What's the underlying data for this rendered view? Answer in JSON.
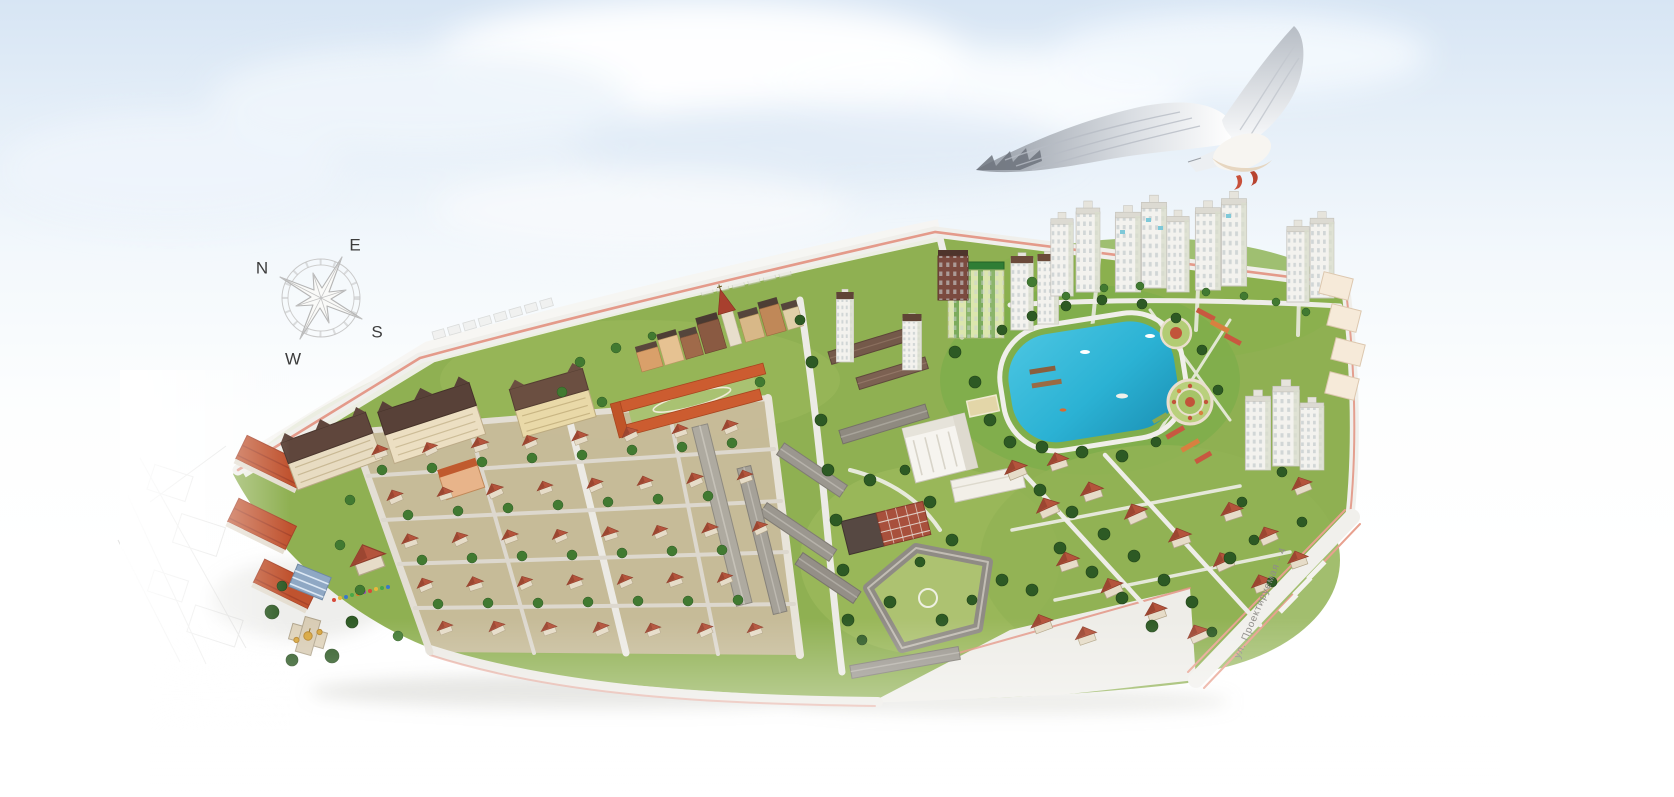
{
  "compass": {
    "north": "N",
    "east": "E",
    "south": "S",
    "west": "W"
  },
  "labels": {
    "street_right_edge": "ул. Проектируемая - 4"
  },
  "icons": {
    "compass-rose-icon": "light-gray line-art eight-point wind rose, tilted, letters at long points",
    "seagull-image": "white seagull photo overlay flying over the plan, wings spread, red feet"
  },
  "colors": {
    "sky_top": "#d7e5f4",
    "sky_bottom": "#ffffff",
    "grass": "#8fb052",
    "grass_dark": "#6e9a3f",
    "tree": "#2d5a24",
    "pond_water": "#2bb2d4",
    "road": "#efeee9",
    "road_edge_salmon": "#e2907f",
    "cottage_roof": "#b4543c",
    "tower_facade": "#f3f2ee",
    "old_town_roof": "#55453c",
    "brick_red": "#a8503c",
    "roof_brown": "#6b4a3a",
    "green_tower_roof": "#2f7d35",
    "gold_dome": "#d7a53b",
    "compass_line": "#b5b5b5",
    "compass_text": "#3c3c3c",
    "street_text": "#8f8d89"
  }
}
